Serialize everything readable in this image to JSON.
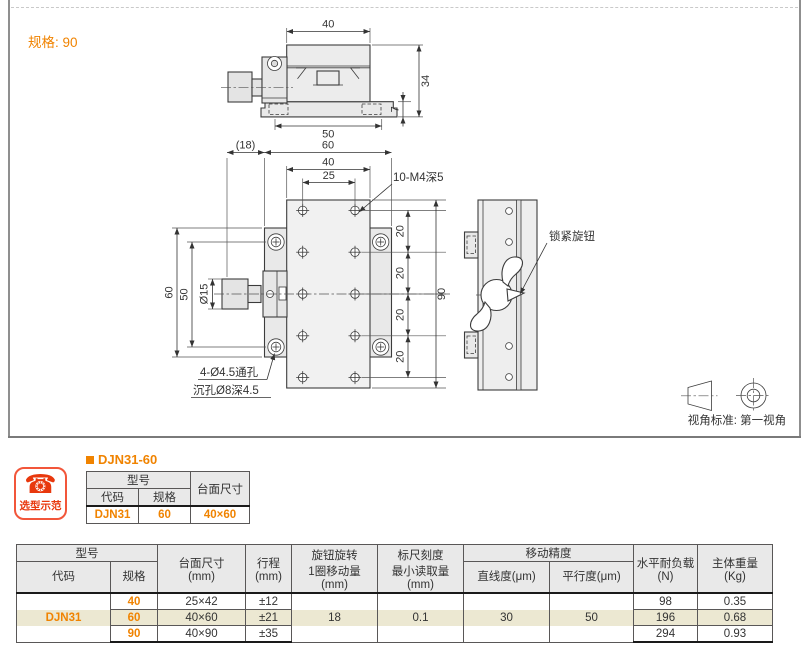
{
  "page": {
    "spec_note": "规格: 90"
  },
  "drawing": {
    "front": {
      "dim_top_width": "40",
      "dim_height": "34",
      "dim_base_height": "7",
      "dim_base_width": "50"
    },
    "plan": {
      "dim_knob_offset": "(18)",
      "dim_saddle_width": "60",
      "dim_plate_width": "40",
      "dim_hole_pitch_x": "25",
      "label_tap": "10-M4深5",
      "dim_pitch_y": "20",
      "dim_plate_length": "90",
      "dim_saddle_length": "60",
      "dim_hole_span_y": "50",
      "dim_knob_dia": "Ø15",
      "label_through": "4-Ø4.5通孔",
      "label_counterbore": "沉孔Ø8深4.5"
    },
    "side": {
      "label_lock_knob": "锁紧旋钮"
    },
    "projection_label": "视角标准: 第一视角"
  },
  "selection": {
    "badge_label": "选型示范",
    "phone_icon": "☎",
    "heading": "DJN31-60",
    "table": {
      "h_model": "型号",
      "h_code": "代码",
      "h_spec": "规格",
      "h_table_size": "台面尺寸",
      "code": "DJN31",
      "spec": "60",
      "table_size": "40×60"
    }
  },
  "spec_table": {
    "h_model": "型号",
    "h_code": "代码",
    "h_spec": "规格",
    "h_table_size": "台面尺寸",
    "h_table_size_unit": "(mm)",
    "h_travel": "行程",
    "h_travel_unit": "(mm)",
    "h_per_turn_1": "旋钮旋转",
    "h_per_turn_2": "1圈移动量",
    "h_per_turn_3": "(mm)",
    "h_scale_1": "标尺刻度",
    "h_scale_2": "最小读取量",
    "h_scale_3": "(mm)",
    "h_accuracy": "移动精度",
    "h_straightness": "直线度(μm)",
    "h_parallelism": "平行度(μm)",
    "h_load": "水平耐负载",
    "h_load_unit": "(N)",
    "h_weight": "主体重量",
    "h_weight_unit": "(Kg)",
    "code": "DJN31",
    "per_turn": "18",
    "scale_min": "0.1",
    "straightness": "30",
    "parallelism": "50",
    "rows": [
      {
        "spec": "40",
        "table_size": "25×42",
        "travel": "±12",
        "load": "98",
        "weight": "0.35"
      },
      {
        "spec": "60",
        "table_size": "40×60",
        "travel": "±21",
        "load": "196",
        "weight": "0.68"
      },
      {
        "spec": "90",
        "table_size": "40×90",
        "travel": "±35",
        "load": "294",
        "weight": "0.93"
      }
    ]
  },
  "colors": {
    "accent_orange": "#f08300",
    "badge_red": "#e8380d",
    "row_highlight": "#ece8d2",
    "header_gray": "#e9e9e9"
  }
}
